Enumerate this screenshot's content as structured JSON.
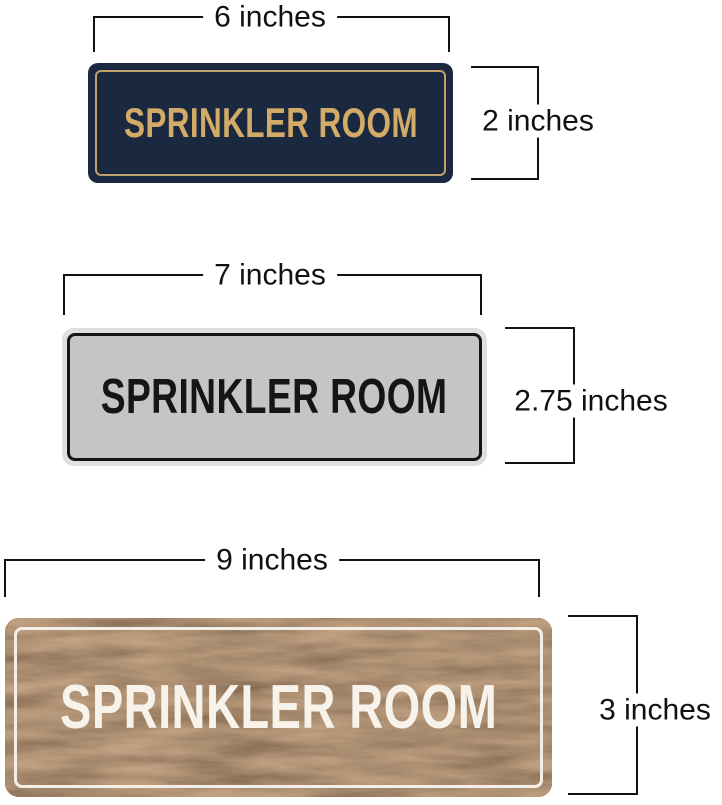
{
  "page": {
    "background": "#ffffff",
    "dimension_line_color": "#111111"
  },
  "signs": [
    {
      "style": "navy-gold",
      "label": "SPRINKLER ROOM",
      "width_label": "6 inches",
      "height_label": "2 inches",
      "colors": {
        "plate": "#1b2940",
        "text": "#d2ab67",
        "border": "#c2a069"
      }
    },
    {
      "style": "silver-black",
      "label": "SPRINKLER ROOM",
      "width_label": "7 inches",
      "height_label": "2.75 inches",
      "colors": {
        "rim": "#dfdfdf",
        "plate": "#c5c5c5",
        "text": "#151515",
        "border": "#151515"
      }
    },
    {
      "style": "walnut-white",
      "label": "SPRINKLER ROOM",
      "width_label": "9 inches",
      "height_label": "3 inches",
      "colors": {
        "plate": "#5d4228",
        "text": "#f7f3ea",
        "border": "#f3efe6"
      }
    }
  ]
}
